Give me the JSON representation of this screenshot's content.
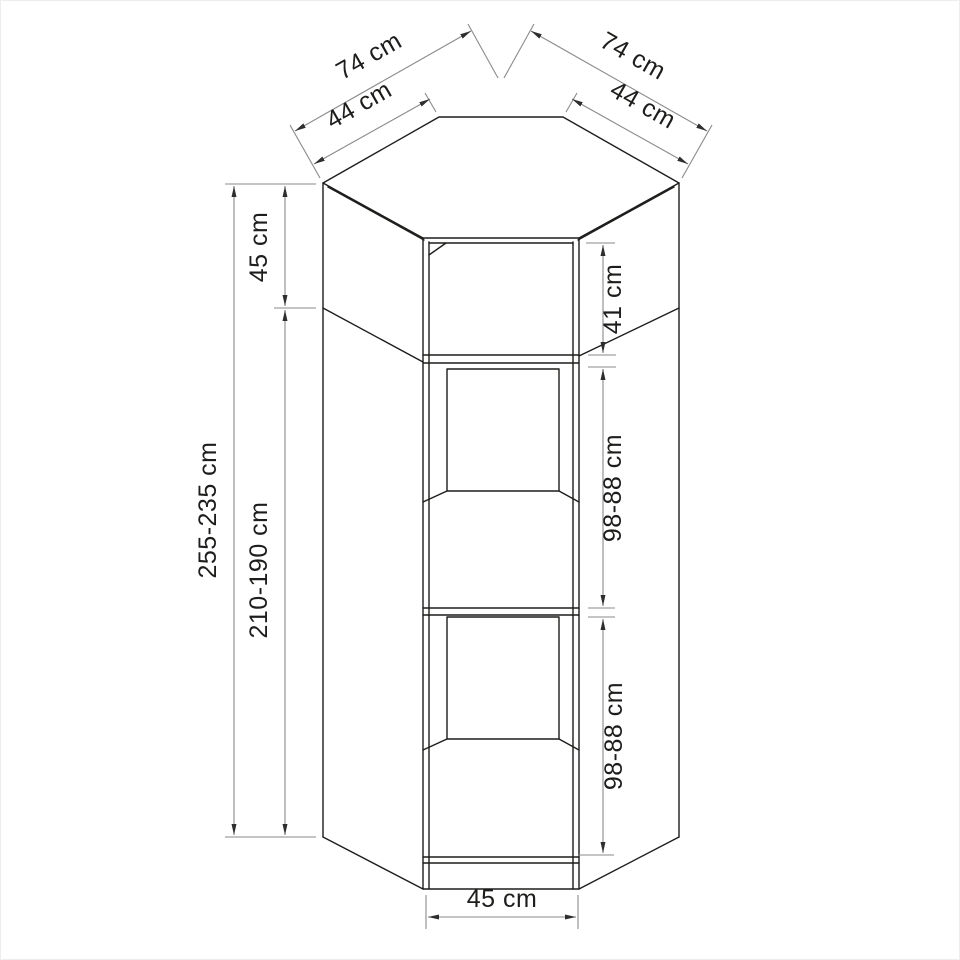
{
  "drawing": {
    "kind": "furniture-dimension-diagram",
    "subject": "corner wardrobe with open shelves, front/axonometric elevation",
    "units": "cm",
    "colors": {
      "background": "#ffffff",
      "cabinet_line": "#1d1d1b",
      "dimension_line": "#8a8a8a",
      "arrow": "#2e2e2e",
      "label_text": "#1d1d1b",
      "page_border": "#ededed"
    }
  },
  "labels": {
    "wall_left": "74 cm",
    "wall_right": "74 cm",
    "side_left": "44 cm",
    "side_right": "44 cm",
    "top_section_left": "45 cm",
    "top_section_right": "41 cm",
    "total_height": "255-235 cm",
    "interior_height": "210-190 cm",
    "upper_compartment": "98-88 cm",
    "lower_compartment": "98-88 cm",
    "front_width": "45 cm"
  },
  "dimensions": [
    {
      "id": "wall_left",
      "value": "74 cm",
      "orientation": "diagonal-left-top"
    },
    {
      "id": "wall_right",
      "value": "74 cm",
      "orientation": "diagonal-right-top"
    },
    {
      "id": "side_left",
      "value": "44 cm",
      "orientation": "diagonal-left-top"
    },
    {
      "id": "side_right",
      "value": "44 cm",
      "orientation": "diagonal-right-top"
    },
    {
      "id": "top_section_left",
      "value": "45 cm",
      "orientation": "vertical-left"
    },
    {
      "id": "top_section_right",
      "value": "41 cm",
      "orientation": "vertical-right"
    },
    {
      "id": "total_height",
      "value": "255-235 cm",
      "orientation": "vertical-left"
    },
    {
      "id": "interior_height",
      "value": "210-190 cm",
      "orientation": "vertical-left"
    },
    {
      "id": "upper_compartment",
      "value": "98-88 cm",
      "orientation": "vertical-right"
    },
    {
      "id": "lower_compartment",
      "value": "98-88 cm",
      "orientation": "vertical-right"
    },
    {
      "id": "front_width",
      "value": "45 cm",
      "orientation": "horizontal-bottom"
    }
  ]
}
